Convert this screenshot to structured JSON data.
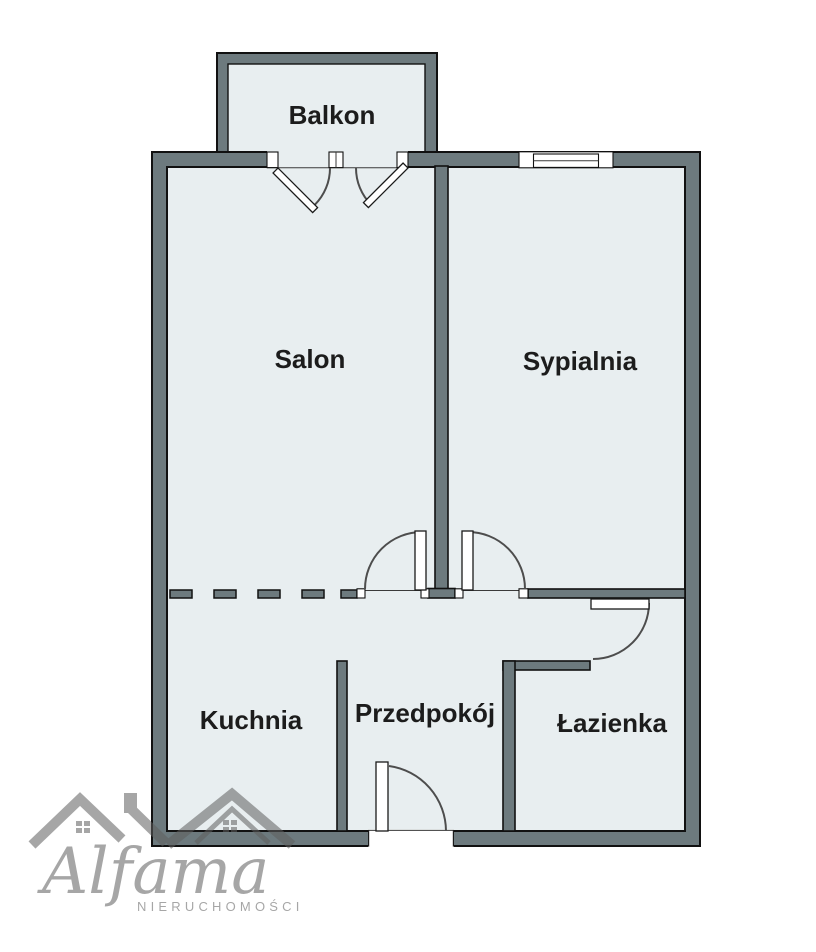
{
  "floorplan": {
    "rooms": [
      {
        "id": "balkon",
        "label": "Balkon"
      },
      {
        "id": "salon",
        "label": "Salon"
      },
      {
        "id": "sypialnia",
        "label": "Sypialnia"
      },
      {
        "id": "kuchnia",
        "label": "Kuchnia"
      },
      {
        "id": "przedpokoj",
        "label": "Przedpokój"
      },
      {
        "id": "lazienka",
        "label": "Łazienka"
      }
    ],
    "colors": {
      "wall_fill": "#6d7a7e",
      "floor_fill": "#e8eef0",
      "outline": "#111111",
      "door_arc": "#4d4d4d",
      "label_text": "#1c1c1c",
      "watermark_gray": "#a6a6a6",
      "background": "#ffffff"
    }
  },
  "watermark": {
    "brand": "Alfama",
    "subtitle": "NIERUCHOMOŚCI"
  }
}
